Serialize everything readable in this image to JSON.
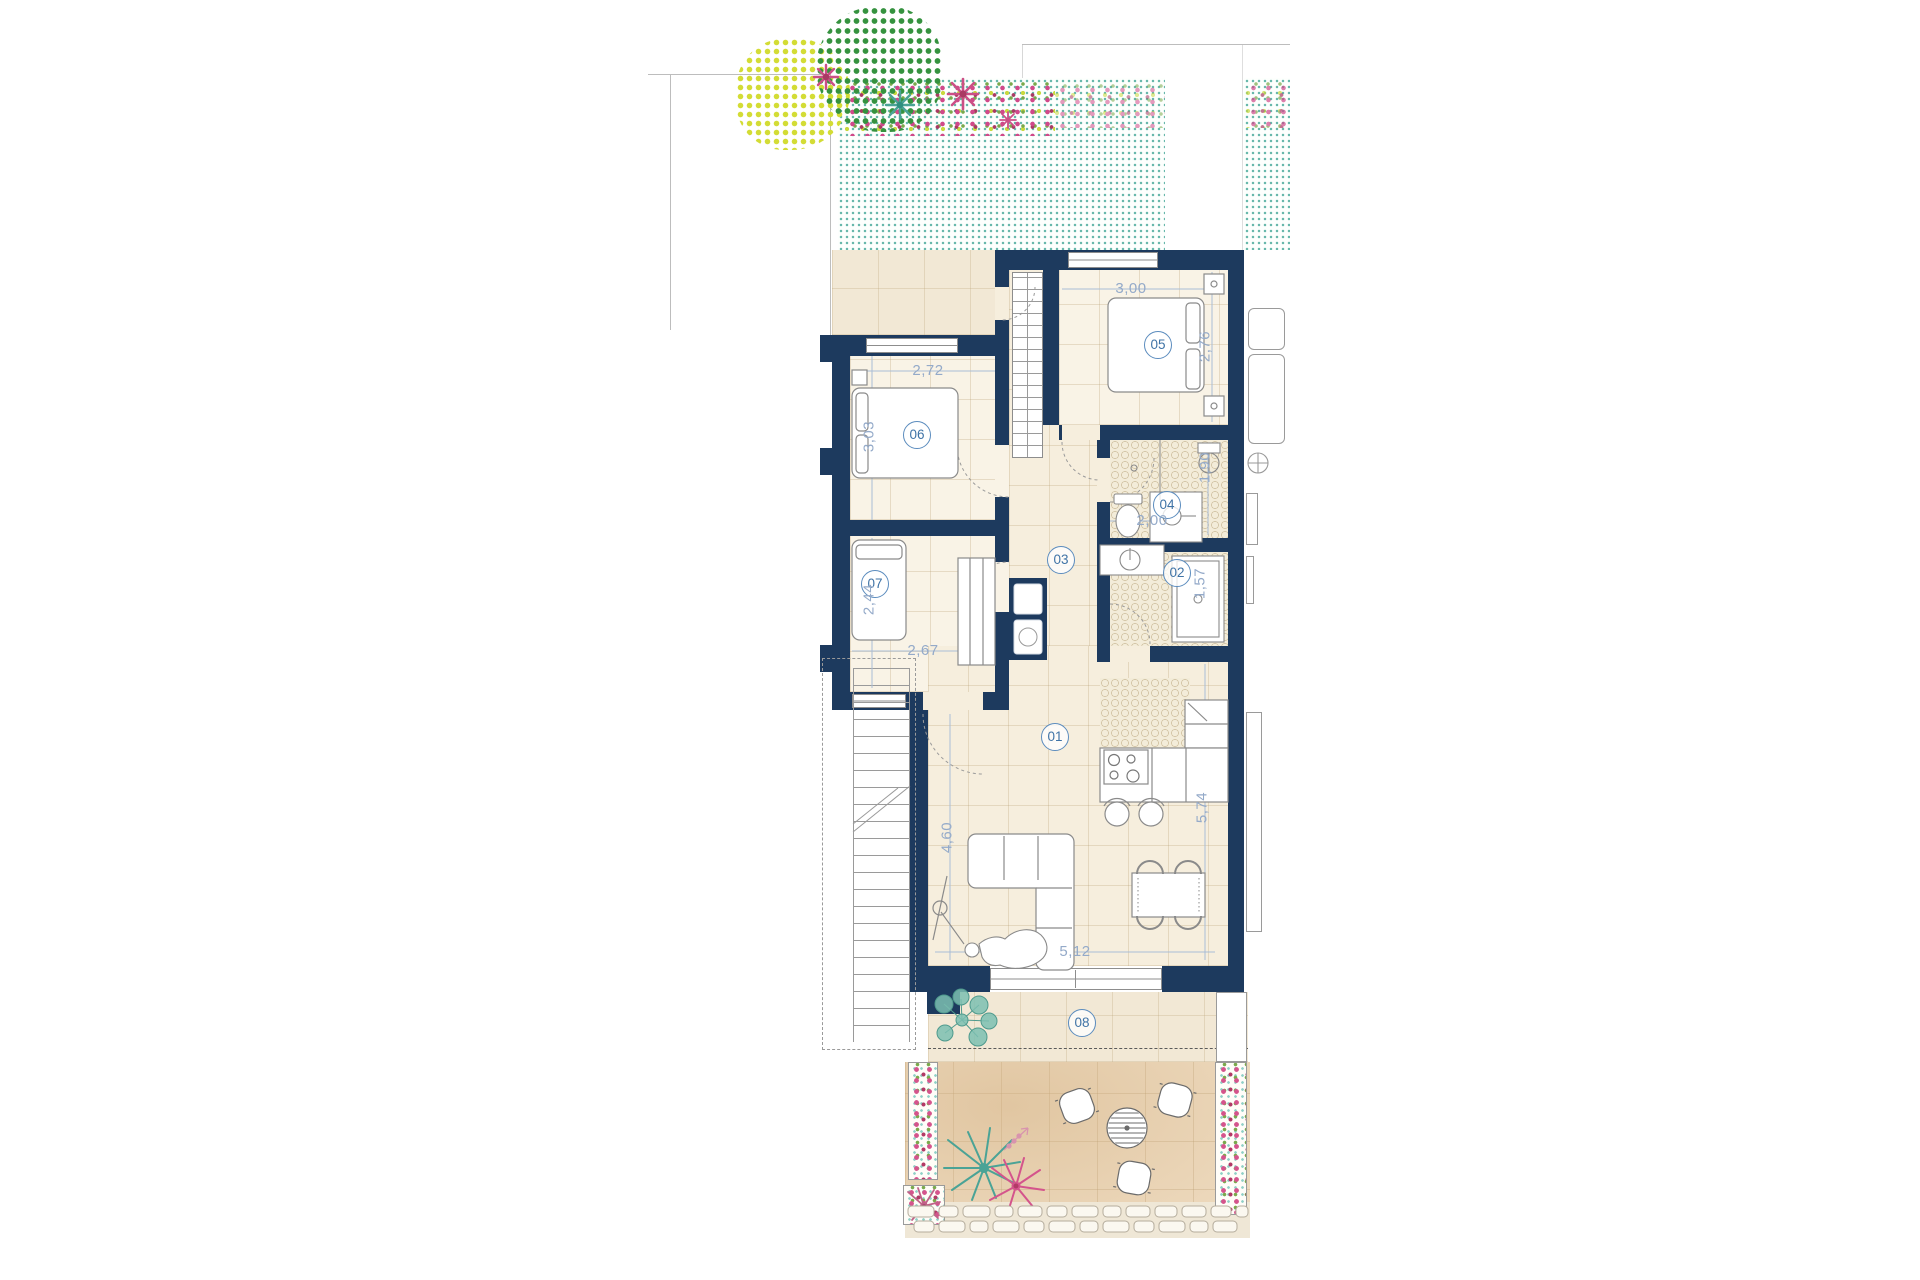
{
  "plan": {
    "type": "residential-floor-plan",
    "rooms": [
      {
        "number": "01"
      },
      {
        "number": "02"
      },
      {
        "number": "03"
      },
      {
        "number": "04"
      },
      {
        "number": "05"
      },
      {
        "number": "06"
      },
      {
        "number": "07"
      },
      {
        "number": "08"
      }
    ],
    "dimensions": [
      {
        "value": "3,00"
      },
      {
        "value": "2,76"
      },
      {
        "value": "2,72"
      },
      {
        "value": "3,03"
      },
      {
        "value": "2,00"
      },
      {
        "value": "1,90"
      },
      {
        "value": "1,57"
      },
      {
        "value": "2,44"
      },
      {
        "value": "2,67"
      },
      {
        "value": "4,60"
      },
      {
        "value": "5,74"
      },
      {
        "value": "5,12"
      }
    ],
    "colors": {
      "wall_navy": "#1d3a5e",
      "floor_beige": "#f6eedd",
      "terrace_tan": "#edd9bd",
      "garden_teal_dot": "#68b8ab",
      "label_blue": "#3f73a6",
      "dimension_blue": "#94aac9",
      "flower_pink": "#d4548c",
      "flower_crimson": "#b23a66",
      "leaf_green": "#79a94b",
      "tree_yellow": "#d3dc35",
      "tree_green": "#35923f",
      "plant_teal": "#4aa396"
    }
  }
}
